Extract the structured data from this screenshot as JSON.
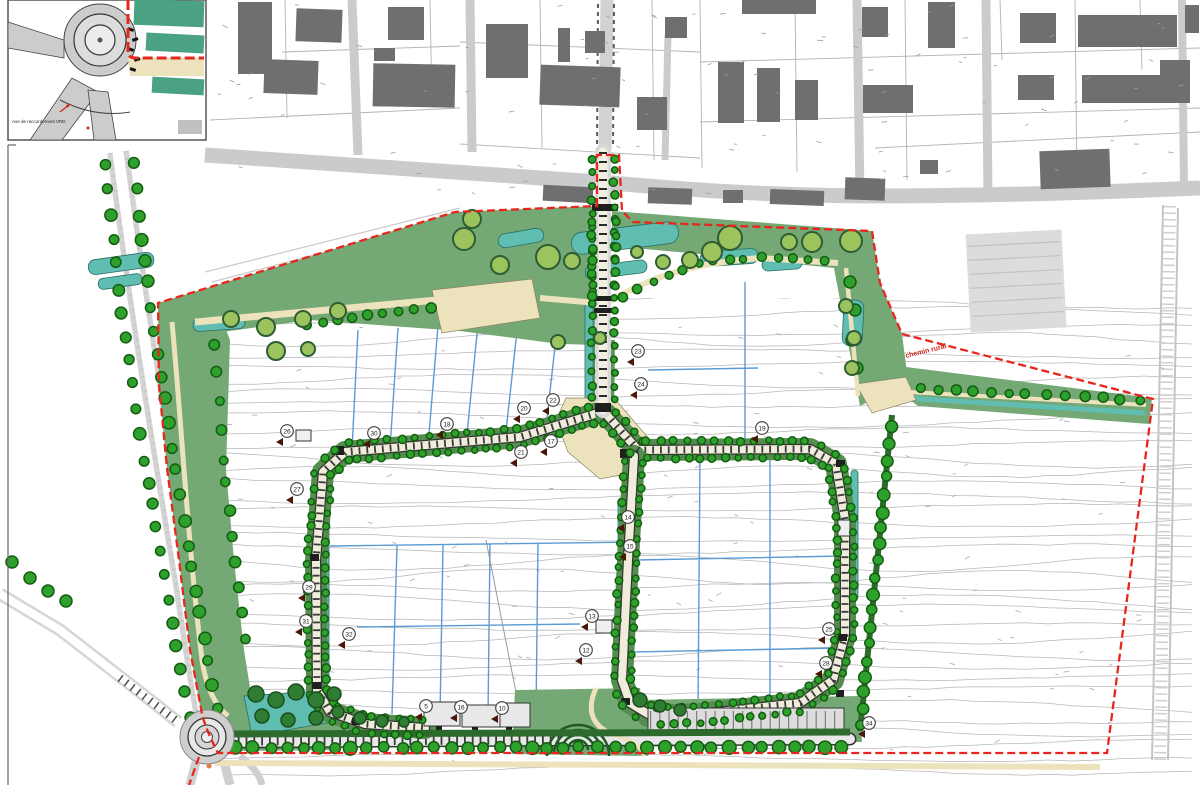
{
  "map": {
    "inset": {
      "caption": "Axe de raccordement VRD"
    },
    "annotations": {
      "boundary_label": "chemin rural"
    },
    "colors": {
      "boundary_red": "#e8261d",
      "park_green": "#74a874",
      "verge_green": "#548e4f",
      "hedge_green": "#2d6b2d",
      "tree_bright": "#2ea02c",
      "tree_ring": "#135c10",
      "big_tree_fill": "#9cc45e",
      "big_tree_ring": "#2f5d33",
      "water_teal": "#5fbdb2",
      "path_beige": "#ece3bd",
      "building_gray": "#6f6f6f",
      "road_gray": "#cdcdcd",
      "contour_gray": "#b7b7b7",
      "plot_blue": "#5b9bd5"
    },
    "markers": [
      {
        "x": 638,
        "y": 351,
        "label": "23"
      },
      {
        "x": 641,
        "y": 384,
        "label": "24"
      },
      {
        "x": 553,
        "y": 400,
        "label": "22"
      },
      {
        "x": 524,
        "y": 408,
        "label": "20"
      },
      {
        "x": 447,
        "y": 424,
        "label": "18"
      },
      {
        "x": 551,
        "y": 441,
        "label": "17"
      },
      {
        "x": 521,
        "y": 452,
        "label": "21"
      },
      {
        "x": 762,
        "y": 428,
        "label": "19"
      },
      {
        "x": 287,
        "y": 431,
        "label": "26"
      },
      {
        "x": 374,
        "y": 433,
        "label": "30"
      },
      {
        "x": 297,
        "y": 489,
        "label": "27"
      },
      {
        "x": 309,
        "y": 587,
        "label": "29"
      },
      {
        "x": 306,
        "y": 621,
        "label": "31"
      },
      {
        "x": 349,
        "y": 634,
        "label": "32"
      },
      {
        "x": 628,
        "y": 517,
        "label": "14"
      },
      {
        "x": 630,
        "y": 546,
        "label": "15"
      },
      {
        "x": 592,
        "y": 616,
        "label": "13"
      },
      {
        "x": 586,
        "y": 650,
        "label": "12"
      },
      {
        "x": 829,
        "y": 629,
        "label": "25"
      },
      {
        "x": 826,
        "y": 663,
        "label": "28"
      },
      {
        "x": 869,
        "y": 723,
        "label": "34"
      },
      {
        "x": 426,
        "y": 706,
        "label": "5"
      },
      {
        "x": 461,
        "y": 707,
        "label": "16"
      },
      {
        "x": 502,
        "y": 708,
        "label": "10"
      }
    ]
  }
}
